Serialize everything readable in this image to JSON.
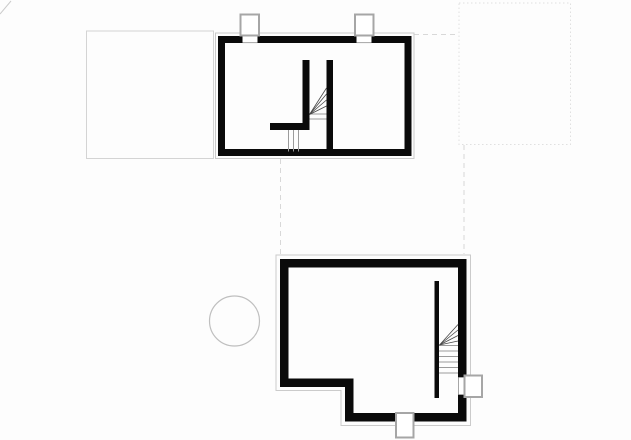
{
  "canvas": {
    "width": 631,
    "height": 440,
    "background": "#fdfdfd"
  },
  "drawing_title": "floor-plans-two-levels",
  "colors": {
    "background": "#fdfdfd",
    "paper": "#ffffff",
    "wall": "#0a0a0a",
    "outline": "#cbcbcb",
    "site_line": "#d4d4d4",
    "dotted_line": "#e0e0e0",
    "dashed_line": "#d8d8d8",
    "marker_line": "#a6a6a6",
    "tread_line": "#9b9b9b",
    "fan_line": "#474747",
    "circle_line": "#bfbfbf"
  },
  "elements": [
    {
      "name": "corner-tick",
      "type": "line",
      "x1": 0,
      "y1": 14,
      "x2": 11,
      "y2": 1,
      "stroke": "outline",
      "width": 1
    },
    {
      "name": "site-rect-left",
      "type": "rect",
      "x": 86.5,
      "y": 31,
      "w": 127,
      "h": 127.5,
      "stroke": "site_line",
      "width": 1
    },
    {
      "name": "site-rect-dotted",
      "type": "rect",
      "x": 459,
      "y": 3,
      "w": 111.5,
      "h": 141.5,
      "stroke": "dotted_line",
      "width": 1,
      "dash": "1.5 2.5"
    },
    {
      "name": "projection-dash-horizontal",
      "type": "line",
      "x1": 414,
      "y1": 34.5,
      "x2": 459,
      "y2": 34.5,
      "stroke": "dashed_line",
      "width": 1,
      "dash": "5 4"
    },
    {
      "name": "projection-dash-left",
      "type": "line",
      "x1": 280.5,
      "y1": 159,
      "x2": 280.5,
      "y2": 254,
      "stroke": "dashed_line",
      "width": 1,
      "dash": "5 4"
    },
    {
      "name": "projection-dash-right",
      "type": "line",
      "x1": 464,
      "y1": 145,
      "x2": 464,
      "y2": 254,
      "stroke": "dashed_line",
      "width": 1,
      "dash": "5 4"
    },
    {
      "name": "upper-plan-outline",
      "type": "rect",
      "x": 215.5,
      "y": 33,
      "w": 198.5,
      "h": 125.5,
      "stroke": "outline",
      "width": 1
    },
    {
      "name": "lower-plan-outline",
      "type": "polygon",
      "points": "276,255 470.5,255 470.5,425.5 341,425.5 341,390.5 276,390.5",
      "stroke": "outline",
      "width": 1
    },
    {
      "name": "tree-circle",
      "type": "circle",
      "cx": 234.5,
      "cy": 321,
      "r": 25,
      "stroke": "circle_line",
      "width": 1.2
    },
    {
      "name": "upper-plan-exterior-wall",
      "type": "rect",
      "x": 221.5,
      "y": 39.5,
      "w": 186.5,
      "h": 113,
      "stroke": "wall",
      "width": 7
    },
    {
      "name": "upper-stair-l-wall",
      "type": "path",
      "d": "M 270,126.5 H 306 V 60",
      "stroke": "wall",
      "width": 7
    },
    {
      "name": "upper-stair-side-wall",
      "type": "line",
      "x1": 329.75,
      "y1": 60,
      "x2": 329.75,
      "y2": 152,
      "stroke": "wall",
      "width": 6.5
    },
    {
      "name": "upper-stair-tread",
      "type": "line",
      "x1": 309.5,
      "y1": 114,
      "x2": 326.5,
      "y2": 114,
      "stroke": "tread_line",
      "width": 1
    },
    {
      "name": "upper-stair-tread",
      "type": "line",
      "x1": 309.5,
      "y1": 119,
      "x2": 326.5,
      "y2": 119,
      "stroke": "tread_line",
      "width": 1
    },
    {
      "name": "upper-stair-winder-line",
      "type": "line",
      "x1": 309.5,
      "y1": 114.5,
      "x2": 326.5,
      "y2": 88,
      "stroke": "fan_line",
      "width": 0.8
    },
    {
      "name": "upper-stair-winder-line",
      "type": "line",
      "x1": 309.5,
      "y1": 114.5,
      "x2": 326.5,
      "y2": 94,
      "stroke": "fan_line",
      "width": 0.8
    },
    {
      "name": "upper-stair-winder-line",
      "type": "line",
      "x1": 309.5,
      "y1": 114.5,
      "x2": 326.5,
      "y2": 100,
      "stroke": "fan_line",
      "width": 0.8
    },
    {
      "name": "upper-stair-winder-line",
      "type": "line",
      "x1": 309.5,
      "y1": 114.5,
      "x2": 326.5,
      "y2": 106,
      "stroke": "fan_line",
      "width": 0.8
    },
    {
      "name": "upper-stair-lower-tread",
      "type": "line",
      "x1": 288.5,
      "y1": 130,
      "x2": 288.5,
      "y2": 151.5,
      "stroke": "tread_line",
      "width": 1
    },
    {
      "name": "upper-stair-lower-tread",
      "type": "line",
      "x1": 293.5,
      "y1": 130,
      "x2": 293.5,
      "y2": 151.5,
      "stroke": "tread_line",
      "width": 1
    },
    {
      "name": "upper-stair-lower-tread",
      "type": "line",
      "x1": 298.5,
      "y1": 130,
      "x2": 298.5,
      "y2": 151.5,
      "stroke": "tread_line",
      "width": 1
    },
    {
      "name": "lower-plan-exterior-wall",
      "type": "path",
      "d": "M 284.25,263.25 H 462.25 V 417.25 H 349.25 V 382.75 H 284.25 Z",
      "stroke": "wall",
      "width": 8.5
    },
    {
      "name": "lower-stair-wall",
      "type": "line",
      "x1": 436.75,
      "y1": 281,
      "x2": 436.75,
      "y2": 398,
      "stroke": "wall",
      "width": 4.5
    },
    {
      "name": "lower-stair-tread",
      "type": "line",
      "x1": 439,
      "y1": 345.5,
      "x2": 458,
      "y2": 345.5,
      "stroke": "tread_line",
      "width": 1
    },
    {
      "name": "lower-stair-tread",
      "type": "line",
      "x1": 439,
      "y1": 351,
      "x2": 458,
      "y2": 351,
      "stroke": "tread_line",
      "width": 1
    },
    {
      "name": "lower-stair-tread",
      "type": "line",
      "x1": 439,
      "y1": 356.5,
      "x2": 458,
      "y2": 356.5,
      "stroke": "tread_line",
      "width": 1
    },
    {
      "name": "lower-stair-tread",
      "type": "line",
      "x1": 439,
      "y1": 362,
      "x2": 458,
      "y2": 362,
      "stroke": "tread_line",
      "width": 1
    },
    {
      "name": "lower-stair-tread",
      "type": "line",
      "x1": 439,
      "y1": 367.5,
      "x2": 458,
      "y2": 367.5,
      "stroke": "tread_line",
      "width": 1
    },
    {
      "name": "lower-stair-tread",
      "type": "line",
      "x1": 439,
      "y1": 373,
      "x2": 458,
      "y2": 373,
      "stroke": "tread_line",
      "width": 1
    },
    {
      "name": "lower-stair-winder-line",
      "type": "line",
      "x1": 439.5,
      "y1": 345,
      "x2": 458,
      "y2": 324.5,
      "stroke": "fan_line",
      "width": 0.8
    },
    {
      "name": "lower-stair-winder-line",
      "type": "line",
      "x1": 439.5,
      "y1": 345,
      "x2": 458,
      "y2": 330,
      "stroke": "fan_line",
      "width": 0.8
    },
    {
      "name": "lower-stair-winder-line",
      "type": "line",
      "x1": 439.5,
      "y1": 345,
      "x2": 458,
      "y2": 335.5,
      "stroke": "fan_line",
      "width": 0.8
    },
    {
      "name": "lower-stair-winder-line",
      "type": "line",
      "x1": 439.5,
      "y1": 345,
      "x2": 458,
      "y2": 341,
      "stroke": "fan_line",
      "width": 0.8
    },
    {
      "name": "upper-vent-gap-a",
      "type": "rect",
      "x": 242.5,
      "y": 35.5,
      "w": 15,
      "h": 7.5,
      "fill": "paper"
    },
    {
      "name": "upper-vent-gap-a-sill",
      "type": "line",
      "x1": 242.5,
      "y1": 42.6,
      "x2": 257.5,
      "y2": 42.6,
      "stroke": "marker_line",
      "width": 1
    },
    {
      "name": "upper-vent-marker-a",
      "type": "rect",
      "x": 240.5,
      "y": 14.5,
      "w": 18.5,
      "h": 21,
      "fill": "paper",
      "stroke": "marker_line",
      "width": 2
    },
    {
      "name": "upper-vent-gap-b",
      "type": "rect",
      "x": 356.5,
      "y": 35.5,
      "w": 15,
      "h": 7.5,
      "fill": "paper"
    },
    {
      "name": "upper-vent-gap-b-sill",
      "type": "line",
      "x1": 356.5,
      "y1": 42.6,
      "x2": 371.5,
      "y2": 42.6,
      "stroke": "marker_line",
      "width": 1
    },
    {
      "name": "upper-vent-marker-b",
      "type": "rect",
      "x": 355,
      "y": 14.5,
      "w": 18.5,
      "h": 21,
      "fill": "paper",
      "stroke": "marker_line",
      "width": 2
    },
    {
      "name": "lower-right-wall-gap",
      "type": "rect",
      "x": 457.5,
      "y": 377.5,
      "w": 10,
      "h": 17,
      "fill": "paper"
    },
    {
      "name": "lower-right-gap-jamb",
      "type": "line",
      "x1": 458.5,
      "y1": 377.5,
      "x2": 458.5,
      "y2": 394.5,
      "stroke": "marker_line",
      "width": 1
    },
    {
      "name": "lower-right-gap-edge",
      "type": "line",
      "x1": 458.5,
      "y1": 377.5,
      "x2": 466,
      "y2": 377.5,
      "stroke": "marker_line",
      "width": 1
    },
    {
      "name": "lower-right-gap-edge",
      "type": "line",
      "x1": 458.5,
      "y1": 394.5,
      "x2": 466,
      "y2": 394.5,
      "stroke": "marker_line",
      "width": 1
    },
    {
      "name": "lower-vent-marker-right",
      "type": "rect",
      "x": 464.5,
      "y": 375.5,
      "w": 17.5,
      "h": 21.5,
      "fill": "paper",
      "stroke": "marker_line",
      "width": 2
    },
    {
      "name": "lower-bottom-wall-gap",
      "type": "rect",
      "x": 396.5,
      "y": 412.5,
      "w": 16.5,
      "h": 10.5,
      "fill": "paper"
    },
    {
      "name": "lower-vent-marker-bottom",
      "type": "rect",
      "x": 396,
      "y": 413,
      "w": 17.5,
      "h": 24.5,
      "fill": "paper",
      "stroke": "marker_line",
      "width": 2
    }
  ]
}
